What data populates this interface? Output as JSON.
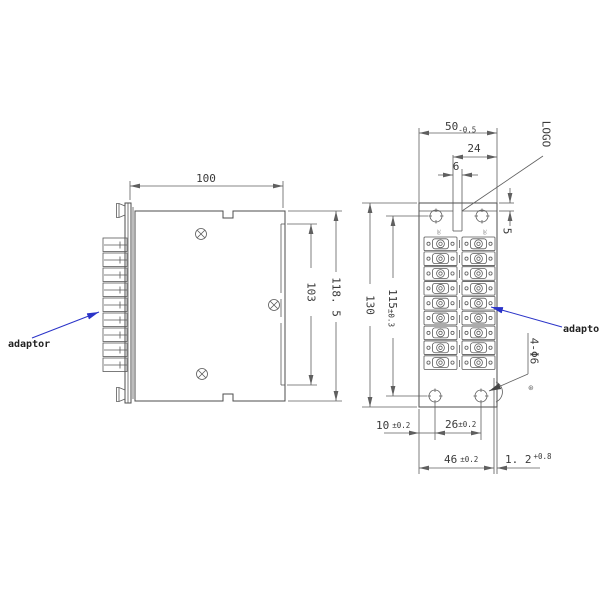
{
  "colors": {
    "line": "#4d4d4d",
    "leader_blue": "#2a33c8",
    "background": "#ffffff"
  },
  "side_view": {
    "dim_width": "100",
    "dim_cover": "103",
    "dim_height": "118. 5",
    "adaptor_label": "adaptor"
  },
  "front_view": {
    "dim_width_v": "50",
    "dim_width_tol": "-0.5",
    "dim_logo_edge": "24",
    "dim_slot": "6",
    "dim_strip": "5",
    "logo": "LOGO",
    "dim_height": "130",
    "dim_holes_v": "115",
    "dim_holes_v_tol": "±0.3",
    "dim_edge_hole": "10",
    "dim_edge_hole_tol": "±0.2",
    "dim_holes_h": "26",
    "dim_holes_h_tol": "±0.2",
    "dim_flange": "46",
    "dim_flange_tol": "±0.2",
    "dim_thickness": "1. 2",
    "dim_thickness_tol": "+0.8",
    "mount_note": "4-Φ6",
    "surface_mark": "⊛",
    "column_mark": "30",
    "adaptor_label": "adaptor"
  }
}
